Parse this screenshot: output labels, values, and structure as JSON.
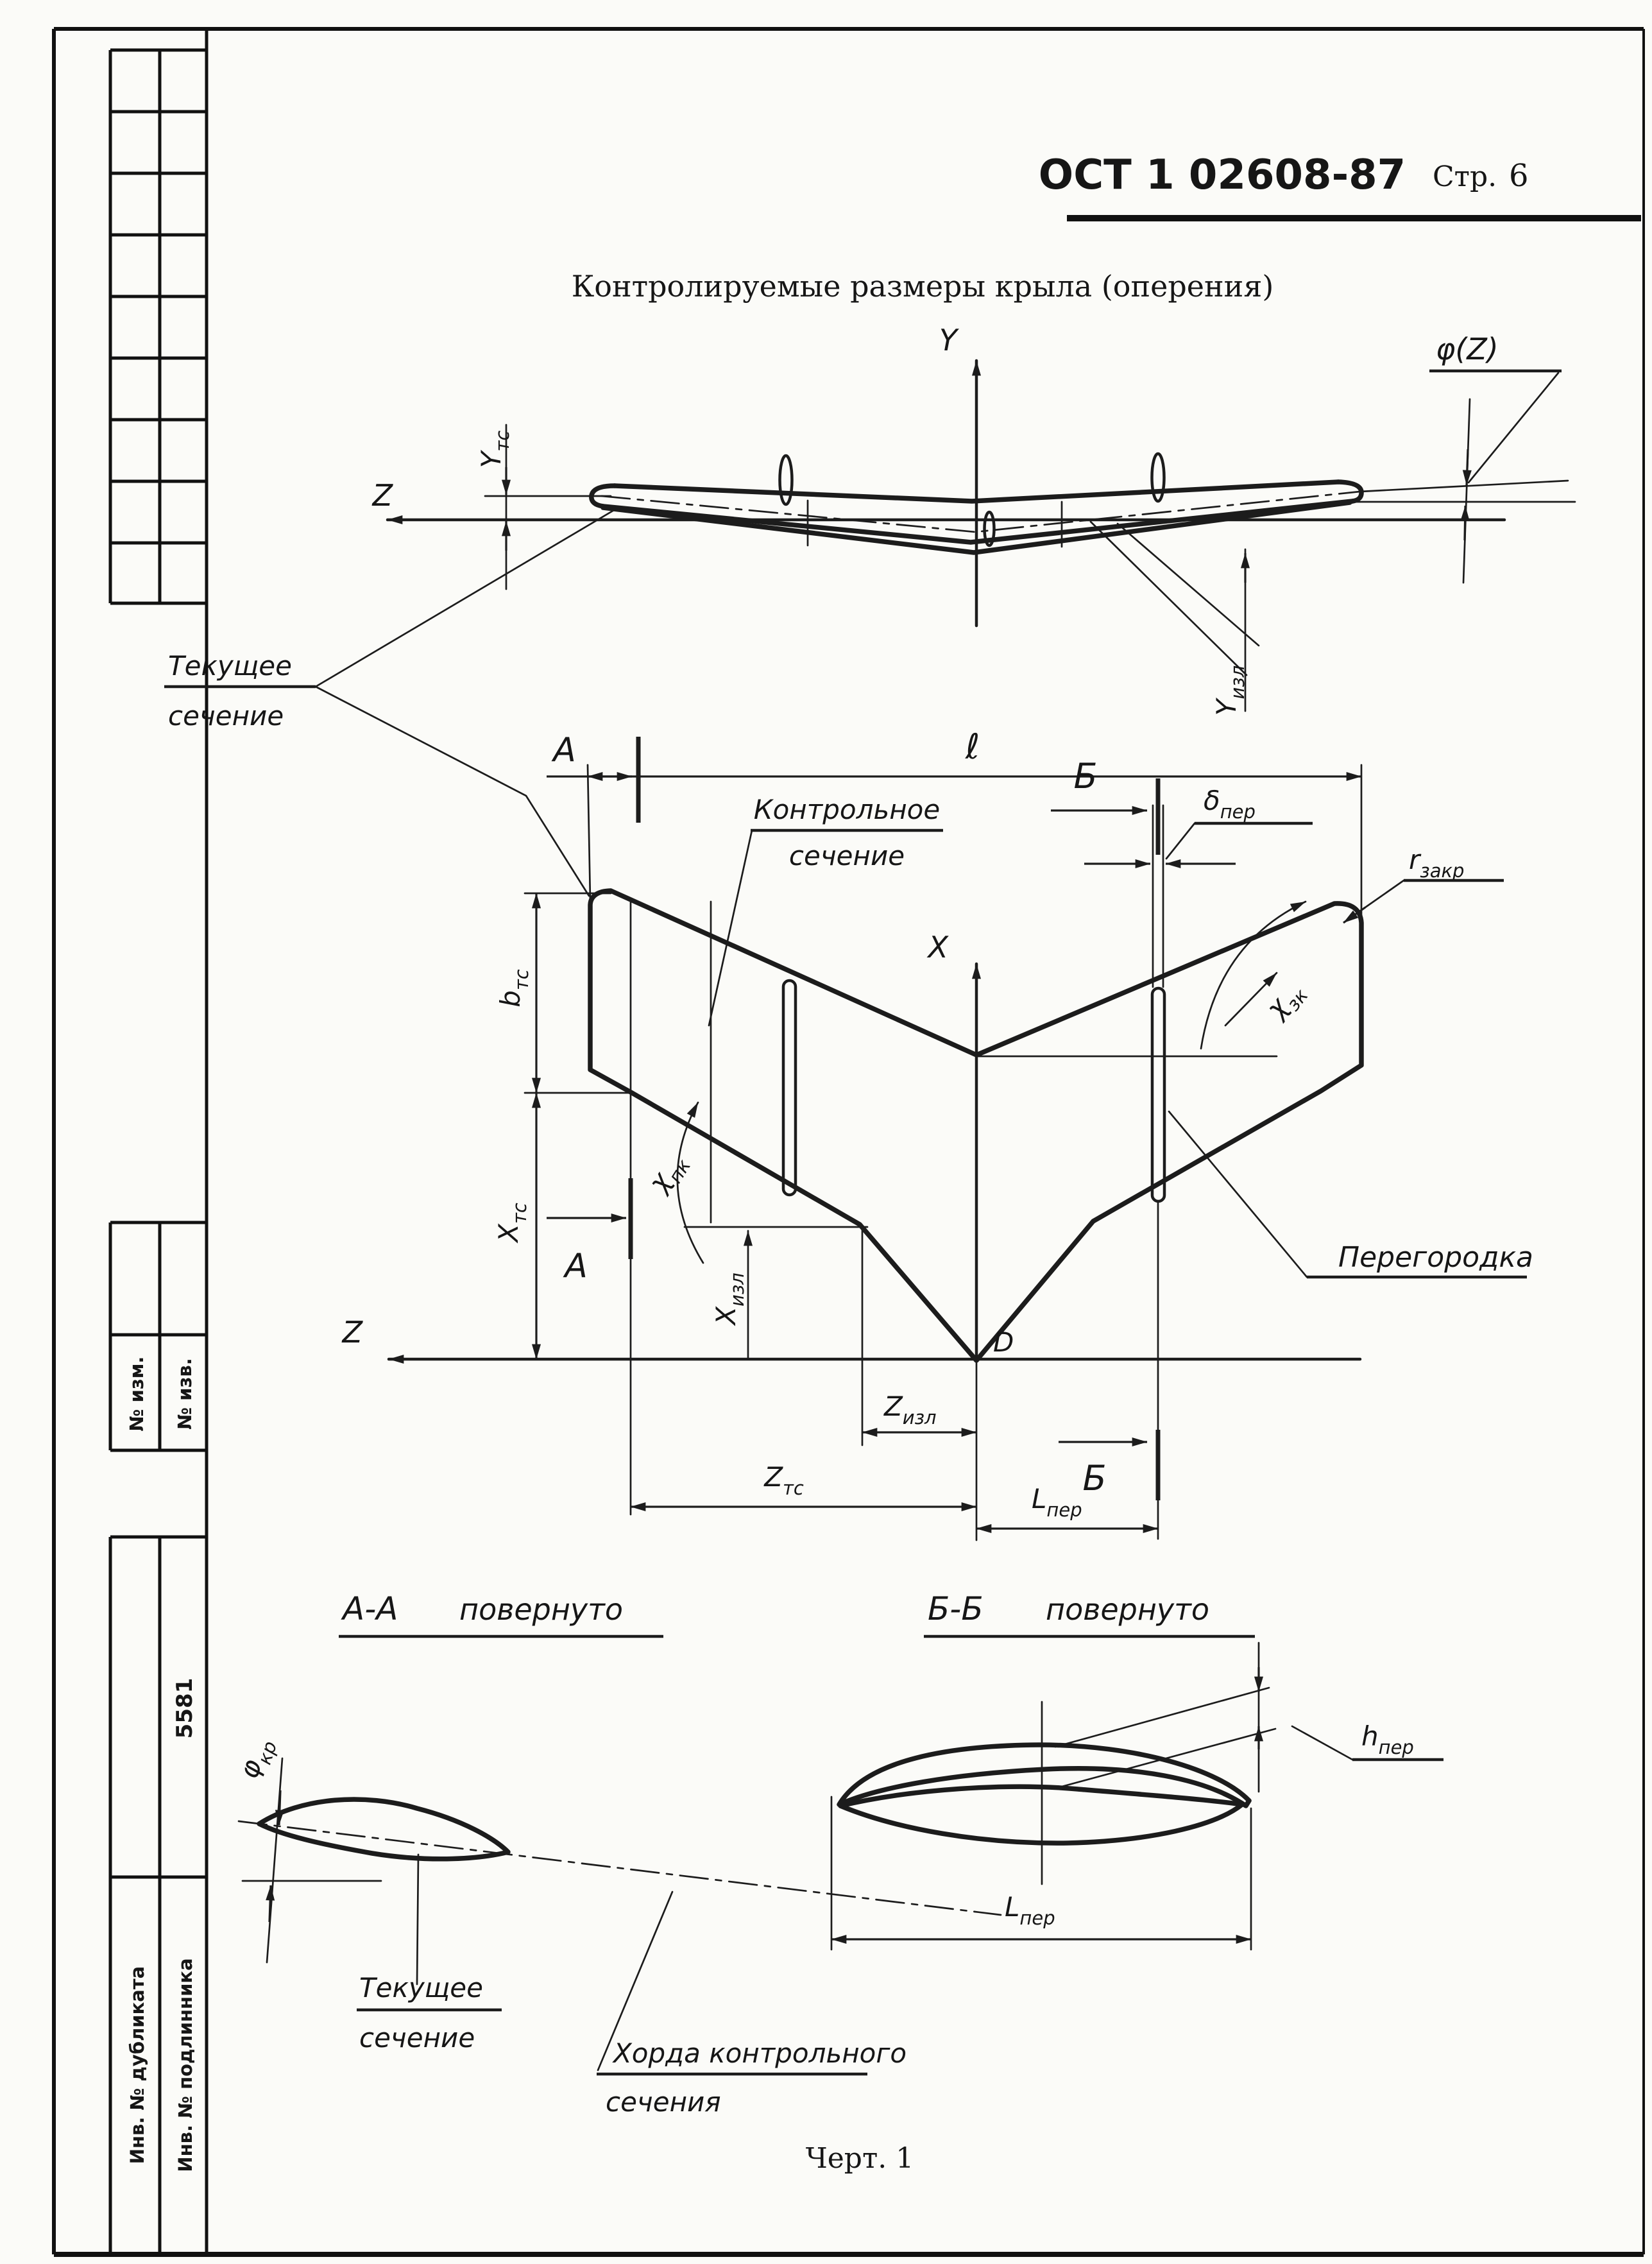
{
  "page": {
    "standard": "ОСТ 1 02608-87",
    "page_label": "Стр.",
    "page_number": "6",
    "title": "Контролируемые размеры крыла (оперения)",
    "figure_caption": "Черт. 1"
  },
  "sidebar": {
    "no_izm": "№ изм.",
    "no_izv": "№ изв.",
    "code": "5581",
    "inv_dublikata": "Инв. № дубликата",
    "inv_podlinnika": "Инв. № подлинника"
  },
  "front_view": {
    "y_axis": "Y",
    "z_axis": "Z",
    "phi_z": "φ(Z)",
    "y_tc": {
      "m": "Y",
      "s": "тс"
    },
    "y_izl": {
      "m": "Y",
      "s": "изл"
    },
    "section_mark": "А",
    "current_section": [
      "Текущее",
      "сечение"
    ]
  },
  "plan_view": {
    "span": "ℓ",
    "x_axis": "X",
    "z_axis": "Z",
    "point_d": "D",
    "section_mark_a": "А",
    "section_mark_b": "Б",
    "b_tc": {
      "m": "b",
      "s": "тс"
    },
    "x_tc": {
      "m": "X",
      "s": "тс"
    },
    "x_izl": {
      "m": "X",
      "s": "изл"
    },
    "z_izl": {
      "m": "Z",
      "s": "изл"
    },
    "z_tc": {
      "m": "Z",
      "s": "тс"
    },
    "l_per": {
      "m": "L",
      "s": "пер"
    },
    "chi_pk": {
      "m": "χ",
      "s": "пк"
    },
    "chi_zk": {
      "m": "χ",
      "s": "зк"
    },
    "delta_per": {
      "m": "δ",
      "s": "пер"
    },
    "r_zakr": {
      "m": "r",
      "s": "закр"
    },
    "control_section": [
      "Контрольное",
      "сечение"
    ],
    "peregorodka": "Перегородка"
  },
  "section_aa": {
    "title": "А-А",
    "rotated": "повернуто",
    "phi_kr": {
      "m": "φ",
      "s": "кр"
    },
    "current_section": [
      "Текущее",
      "сечение"
    ],
    "chord_label": [
      "Хорда контрольного",
      "сечения"
    ]
  },
  "section_bb": {
    "title": "Б-Б",
    "rotated": "повернуто",
    "h_per": {
      "m": "h",
      "s": "пер"
    },
    "l_per": {
      "m": "L",
      "s": "пер"
    }
  }
}
